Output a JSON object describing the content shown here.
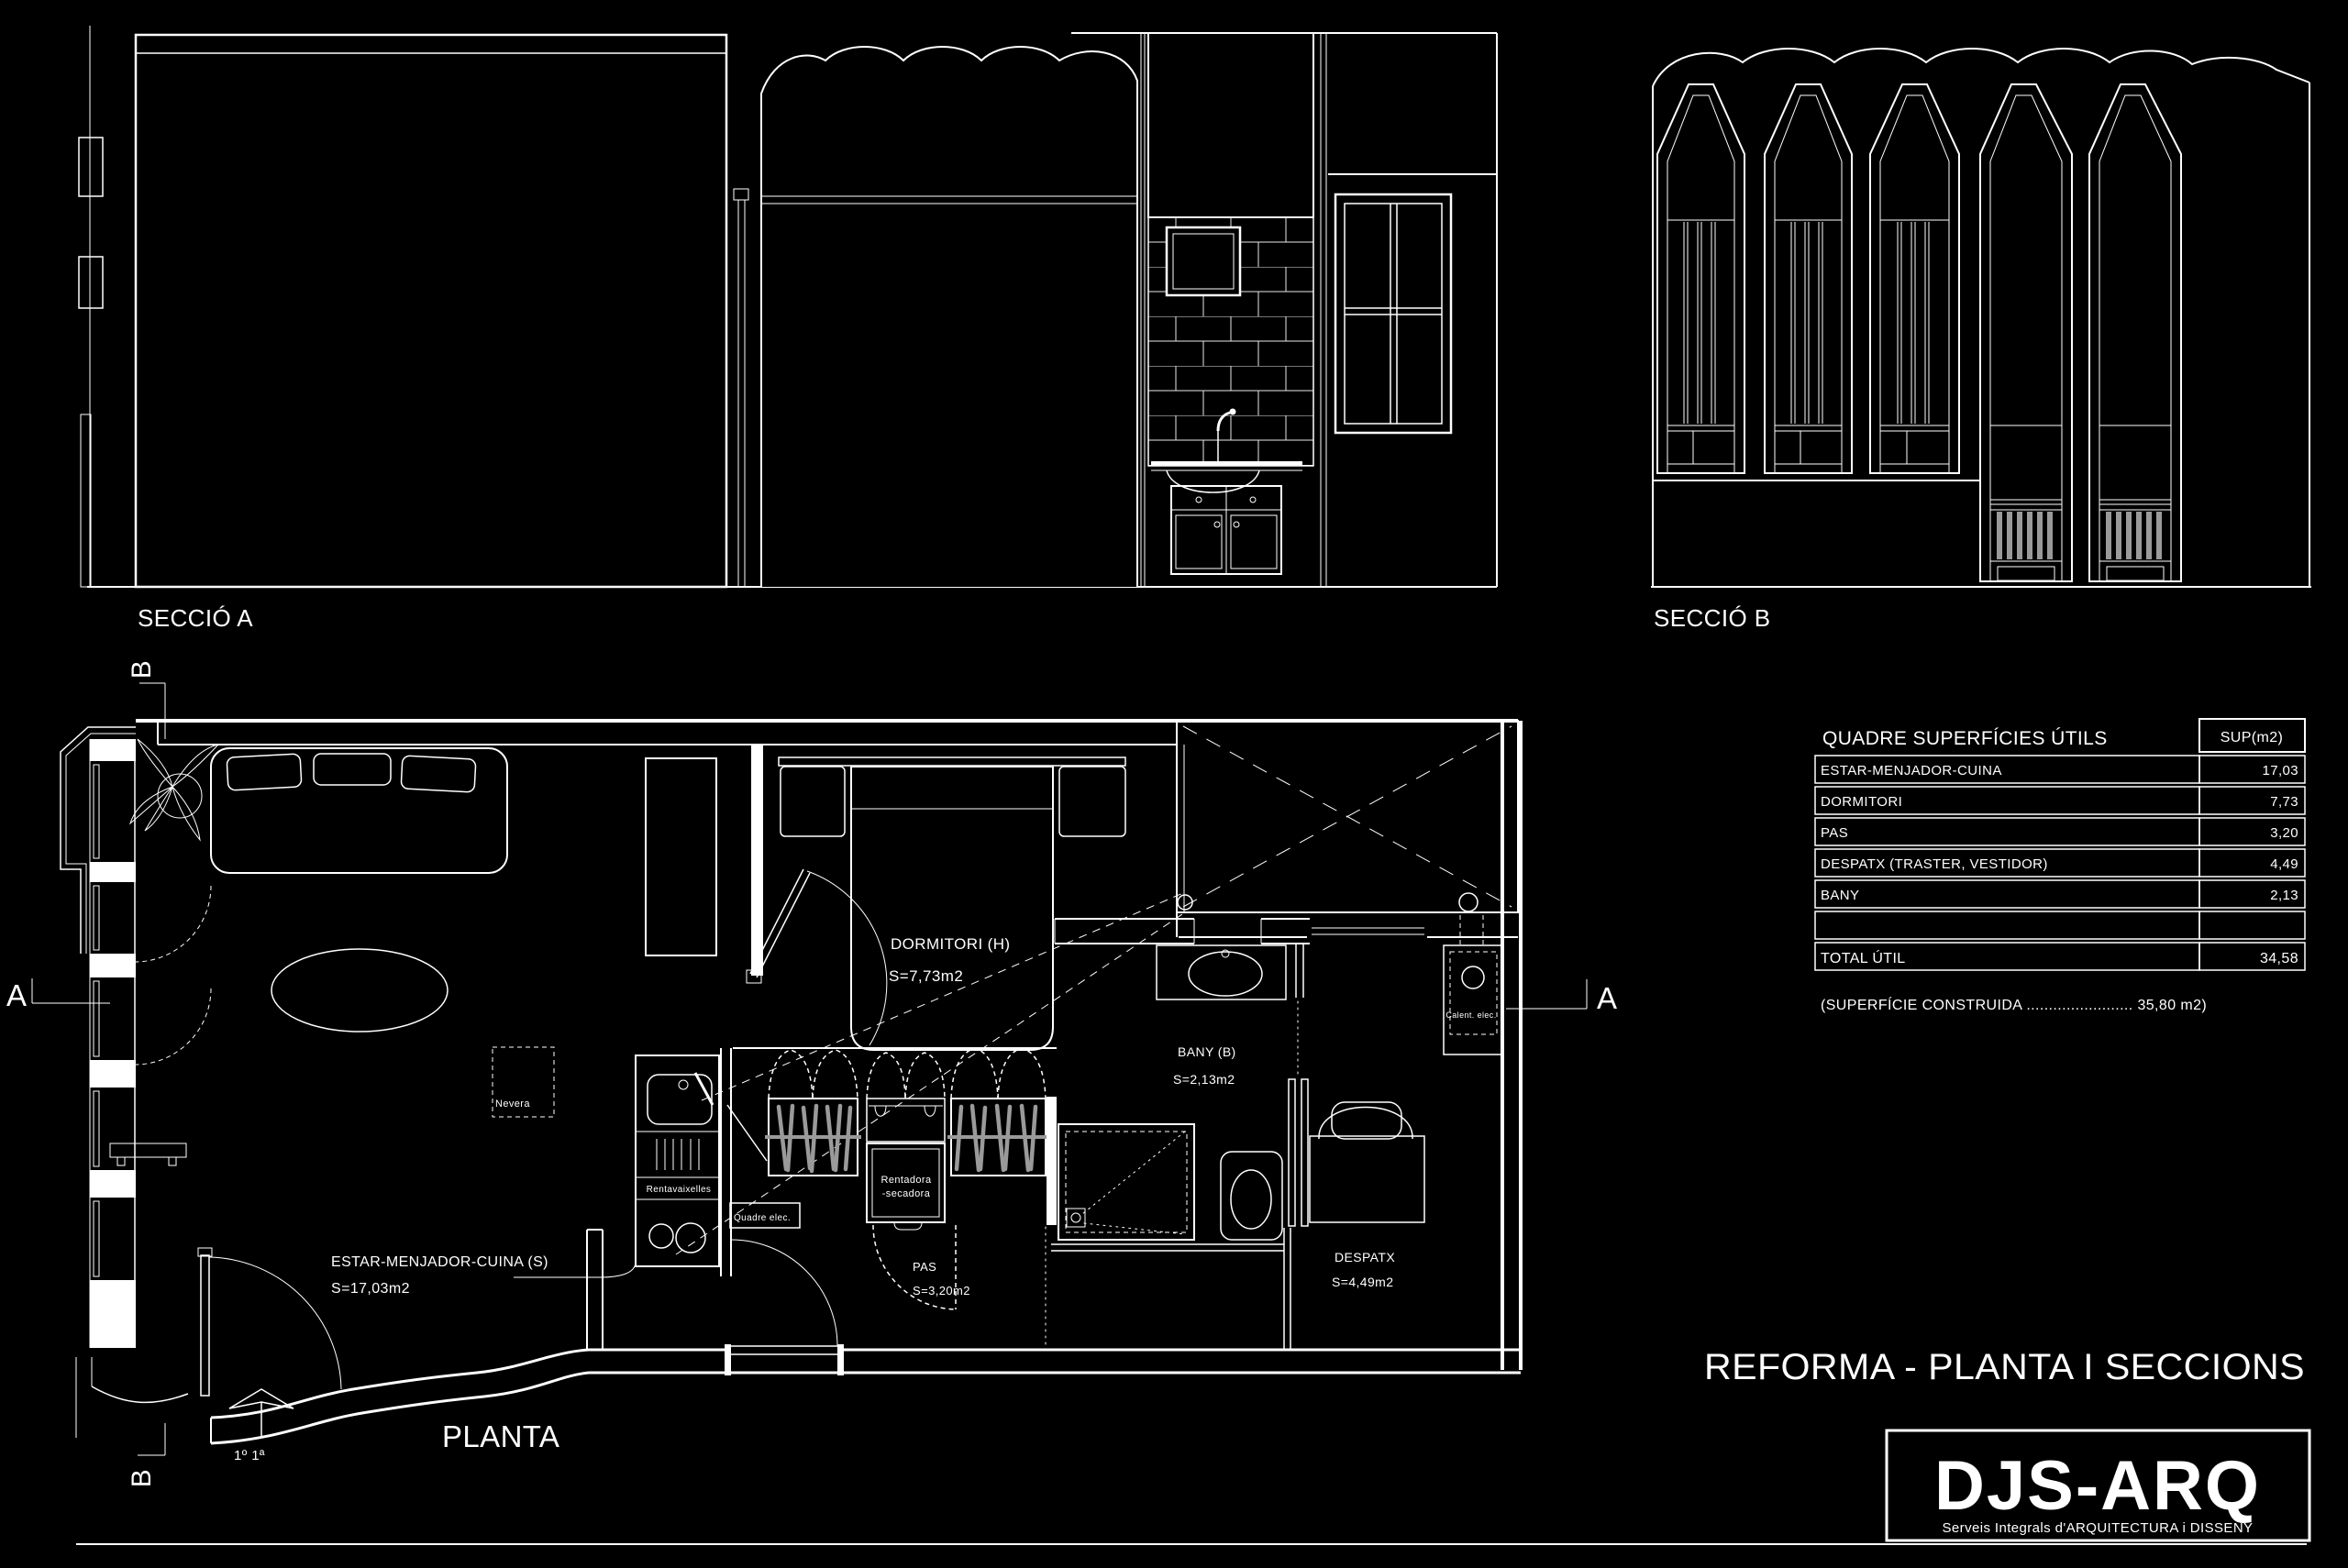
{
  "colors": {
    "background": "#000000",
    "line": "#ffffff",
    "hanger_gray": "#9a9a9a"
  },
  "sections": {
    "seccio_a_label": "SECCIÓ  A",
    "seccio_b_label": "SECCIÓ  B",
    "planta_label": "PLANTA",
    "floor_marker": "1º 1ª"
  },
  "section_markers": {
    "a": "A",
    "b": "B"
  },
  "rooms": {
    "dormitori": {
      "name": "DORMITORI  (H)",
      "area": "S=7,73m2"
    },
    "bany": {
      "name": "BANY (B)",
      "area": "S=2,13m2"
    },
    "despatx": {
      "name": "DESPATX",
      "area": "S=4,49m2"
    },
    "estar": {
      "name": "ESTAR-MENJADOR-CUINA (S)",
      "area": "S=17,03m2"
    },
    "pas": {
      "name": "PAS",
      "area": "S=3,20m2"
    }
  },
  "appliances": {
    "nevera": "Nevera",
    "rentavaixelles": "Rentavaixelles",
    "quadre_elec": "Quadre elec.",
    "rentadora_line1": "Rentadora",
    "rentadora_line2": "-secadora",
    "calent_elec": "Calent. elec."
  },
  "surface_table": {
    "title": "QUADRE SUPERFÍCIES ÚTILS",
    "unit_header": "SUP(m2)",
    "rows": [
      {
        "label": "ESTAR-MENJADOR-CUINA",
        "value": "17,03"
      },
      {
        "label": "DORMITORI",
        "value": "7,73"
      },
      {
        "label": "PAS",
        "value": "3,20"
      },
      {
        "label": "DESPATX (TRASTER, VESTIDOR)",
        "value": "4,49"
      },
      {
        "label": "BANY",
        "value": "2,13"
      }
    ],
    "total": {
      "label": "TOTAL  ÚTIL",
      "value": "34,58"
    },
    "footnote": "(SUPERFÍCIE CONSTRUIDA ........................ 35,80 m2)"
  },
  "title_block": {
    "drawing_title": "REFORMA - PLANTA I SECCIONS",
    "logo": "DJS-ARQ",
    "logo_subtitle": "Serveis Integrals d'ARQUITECTURA i DISSENY"
  }
}
